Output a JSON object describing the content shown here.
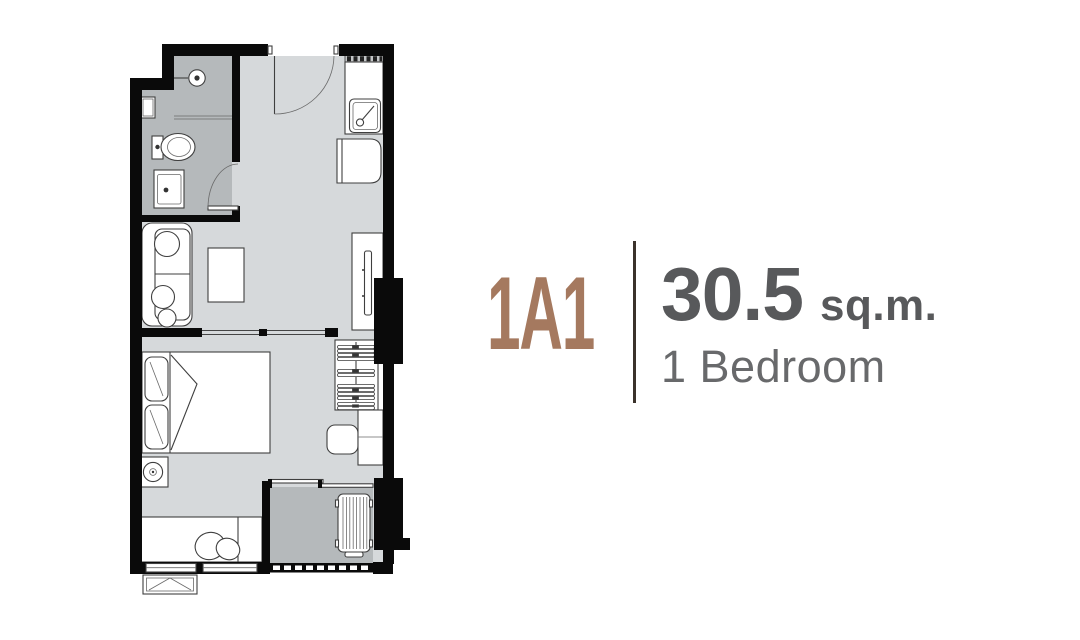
{
  "unit": {
    "code": "1A1",
    "area_value": "30.5",
    "area_unit": "sq.m.",
    "bedrooms": "1 Bedroom"
  },
  "colors": {
    "accent": "#a5795f",
    "divider": "#3b322b",
    "area_text": "#58595b",
    "type_text": "#68696b",
    "wall": "#0a0a0a",
    "floor_main": "#d6d9db",
    "floor_wet": "#b5b9bb",
    "furniture_line": "#3f3f3f",
    "background": "#ffffff"
  }
}
